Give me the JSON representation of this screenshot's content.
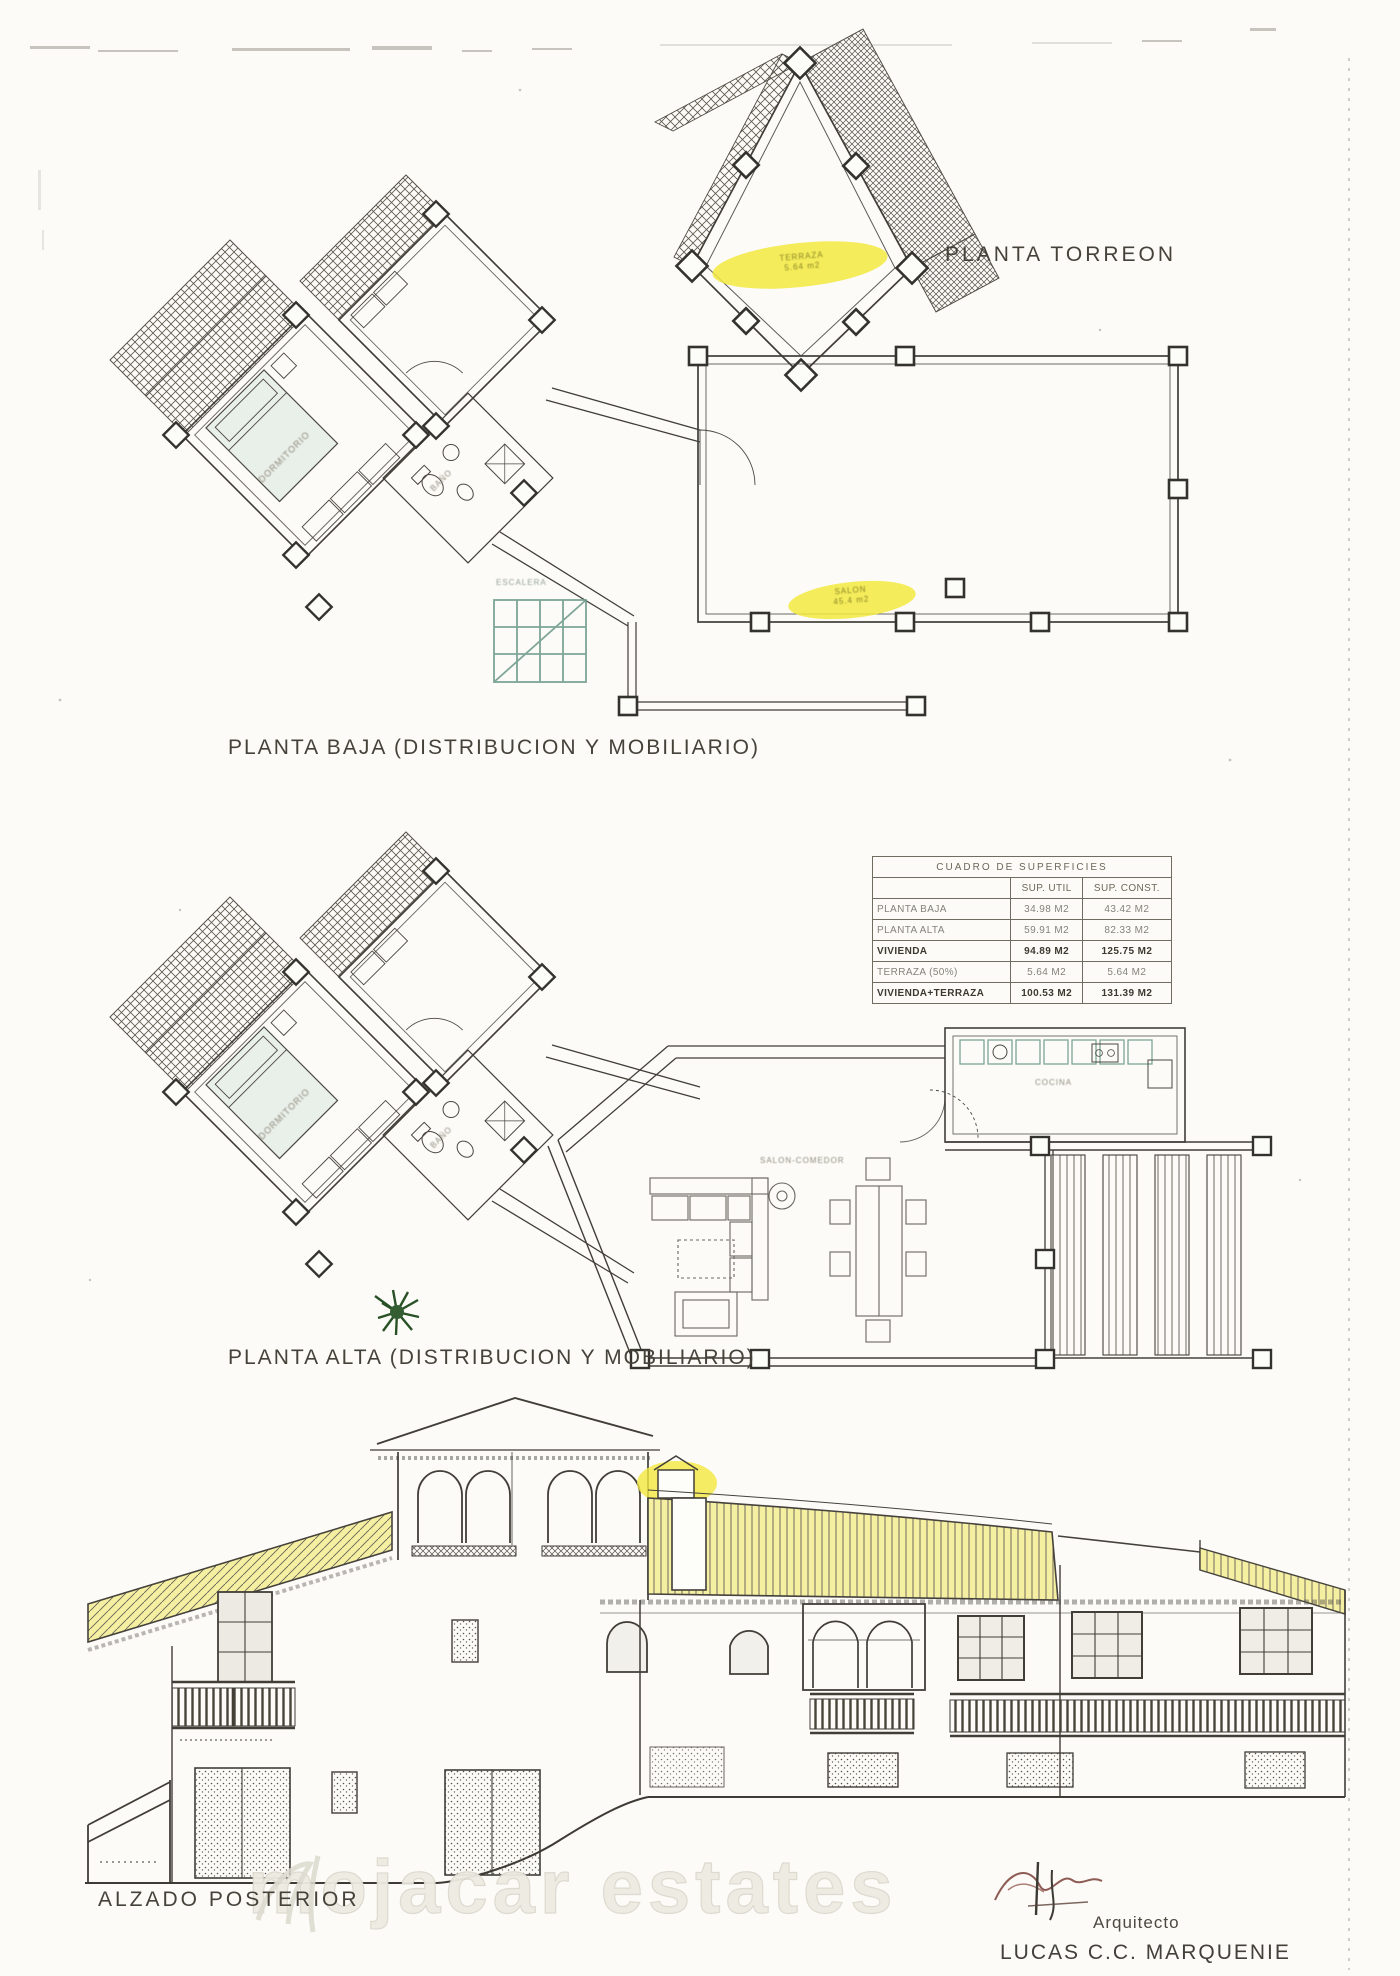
{
  "page": {
    "paper_color": "#fcfbf7",
    "ink_color": "#45423a"
  },
  "colors": {
    "marker_highlight": "#f2e93e",
    "roof_yellow": "#f5efa2",
    "stairs_teal": "#6f9c8d",
    "plant_green": "#2a5526",
    "watermark_gray": "#e6e3d9",
    "signature_brown": "#7a4038"
  },
  "plans": {
    "torreon": {
      "label": "PLANTA TORREON",
      "highlight_line1": "TERRAZA",
      "highlight_line2": "5.64 m2"
    },
    "baja": {
      "label": "PLANTA BAJA (DISTRIBUCION Y MOBILIARIO)",
      "highlight_line1": "SALON",
      "highlight_line2": "45.4 m2",
      "stairs_label": "ESCALERA",
      "bedroom_label": "DORMITORIO",
      "bath_label": "BAÑO"
    },
    "alta": {
      "label": "PLANTA ALTA (DISTRIBUCION Y MOBILIARIO)",
      "bedroom_label": "DORMITORIO",
      "bath_label": "BAÑO",
      "kitchen_label": "COCINA",
      "living_label": "SALON-COMEDOR"
    },
    "alzado": {
      "label": "ALZADO POSTERIOR"
    }
  },
  "table": {
    "title": "CUADRO DE SUPERFICIES",
    "col_util": "SUP. UTIL",
    "col_const": "SUP. CONST.",
    "rows": [
      {
        "label": "PLANTA BAJA",
        "util": "34.98 M2",
        "const": "43.42 M2"
      },
      {
        "label": "PLANTA ALTA",
        "util": "59.91 M2",
        "const": "82.33 M2"
      },
      {
        "label": "VIVIENDA",
        "util": "94.89 M2",
        "const": "125.75 M2"
      },
      {
        "label": "TERRAZA (50%)",
        "util": "5.64 M2",
        "const": "5.64 M2"
      },
      {
        "label": "VIVIENDA+TERRAZA",
        "util": "100.53 M2",
        "const": "131.39 M2"
      }
    ]
  },
  "footer": {
    "watermark": "mojacar estates",
    "architect_title": "Arquitecto",
    "architect_name": "LUCAS C.C. MARQUENIE"
  }
}
